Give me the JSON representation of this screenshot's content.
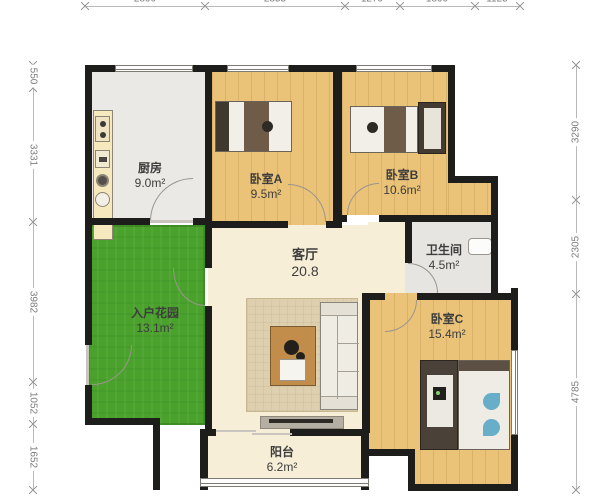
{
  "plan": {
    "type": "residential-floor-plan",
    "rooms": [
      {
        "name": "厨房",
        "area": "9.0m²"
      },
      {
        "name": "卧室A",
        "area": "9.5m²"
      },
      {
        "name": "卧室B",
        "area": "10.6m²"
      },
      {
        "name": "卫生间",
        "area": "4.5m²"
      },
      {
        "name": "客厅",
        "area": "20.8"
      },
      {
        "name": "入户花园",
        "area": "13.1m²"
      },
      {
        "name": "卧室C",
        "area": "15.4m²"
      },
      {
        "name": "阳台",
        "area": "6.2m²"
      }
    ],
    "dimensions_mm": {
      "top": [
        "2890",
        "2855",
        "1279",
        "1890",
        "1125"
      ],
      "left": [
        "550",
        "3331",
        "3982",
        "1052",
        "1652"
      ],
      "right": [
        "3290",
        "2305",
        "4785"
      ]
    },
    "icons": [
      "bed-icon",
      "wardrobe-icon",
      "sofa-icon",
      "coffee-table-icon",
      "tv-cabinet-icon",
      "rug",
      "kitchen-counter",
      "stove-icon",
      "sink-icon",
      "washing-machine-icon",
      "bathroom-sink-icon",
      "door-arc",
      "window-symbol"
    ],
    "colors": {
      "wall": "#1d1d1b",
      "wood_floor": "#eac379",
      "kitchen_floor": "#ebe9e5",
      "bath_floor": "#e7e5e1",
      "living_floor": "#f6eed6",
      "garden": "#4aa22c",
      "dimension_text": "#7c7c7c",
      "label_text": "#3d3d3d"
    }
  }
}
